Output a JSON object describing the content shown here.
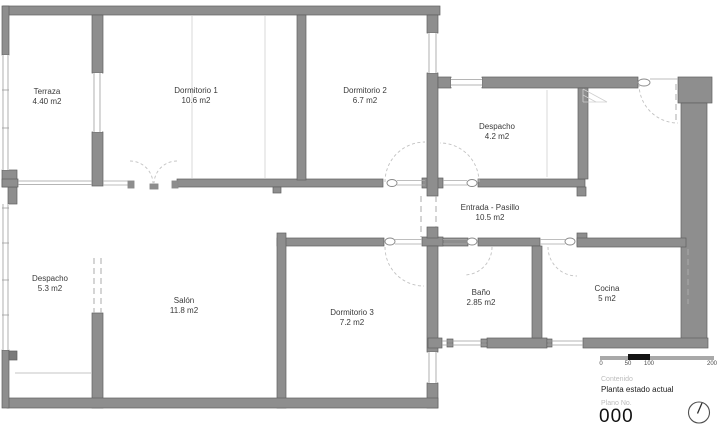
{
  "plan": {
    "rooms": [
      {
        "name": "Terraza",
        "area": "4.40 m2"
      },
      {
        "name": "Dormitorio 1",
        "area": "10.6 m2"
      },
      {
        "name": "Dormitorio 2",
        "area": "6.7 m2"
      },
      {
        "name": "Despacho",
        "area": "4.2 m2"
      },
      {
        "name": "Entrada - Pasillo",
        "area": "10.5 m2"
      },
      {
        "name": "Despacho",
        "area": "5.3 m2"
      },
      {
        "name": "Salón",
        "area": "11.8 m2"
      },
      {
        "name": "Dormitorio 3",
        "area": "7.2 m2"
      },
      {
        "name": "Baño",
        "area": "2.85 m2"
      },
      {
        "name": "Cocina",
        "area": "5 m2"
      }
    ]
  },
  "scalebar": {
    "ticks": [
      "0",
      "50",
      "100",
      "200"
    ]
  },
  "titleblock": {
    "content_label": "Contenido",
    "content_value": "Planta estado actual",
    "plan_no_label": "Plano No.",
    "plan_no_value": "000"
  },
  "colors": {
    "wall": "#8E8E8E",
    "wall_outline": "#606060",
    "scalebar_black": "#141414",
    "muted_label": "#BDBDBD",
    "label_text": "#3A3A3A"
  }
}
